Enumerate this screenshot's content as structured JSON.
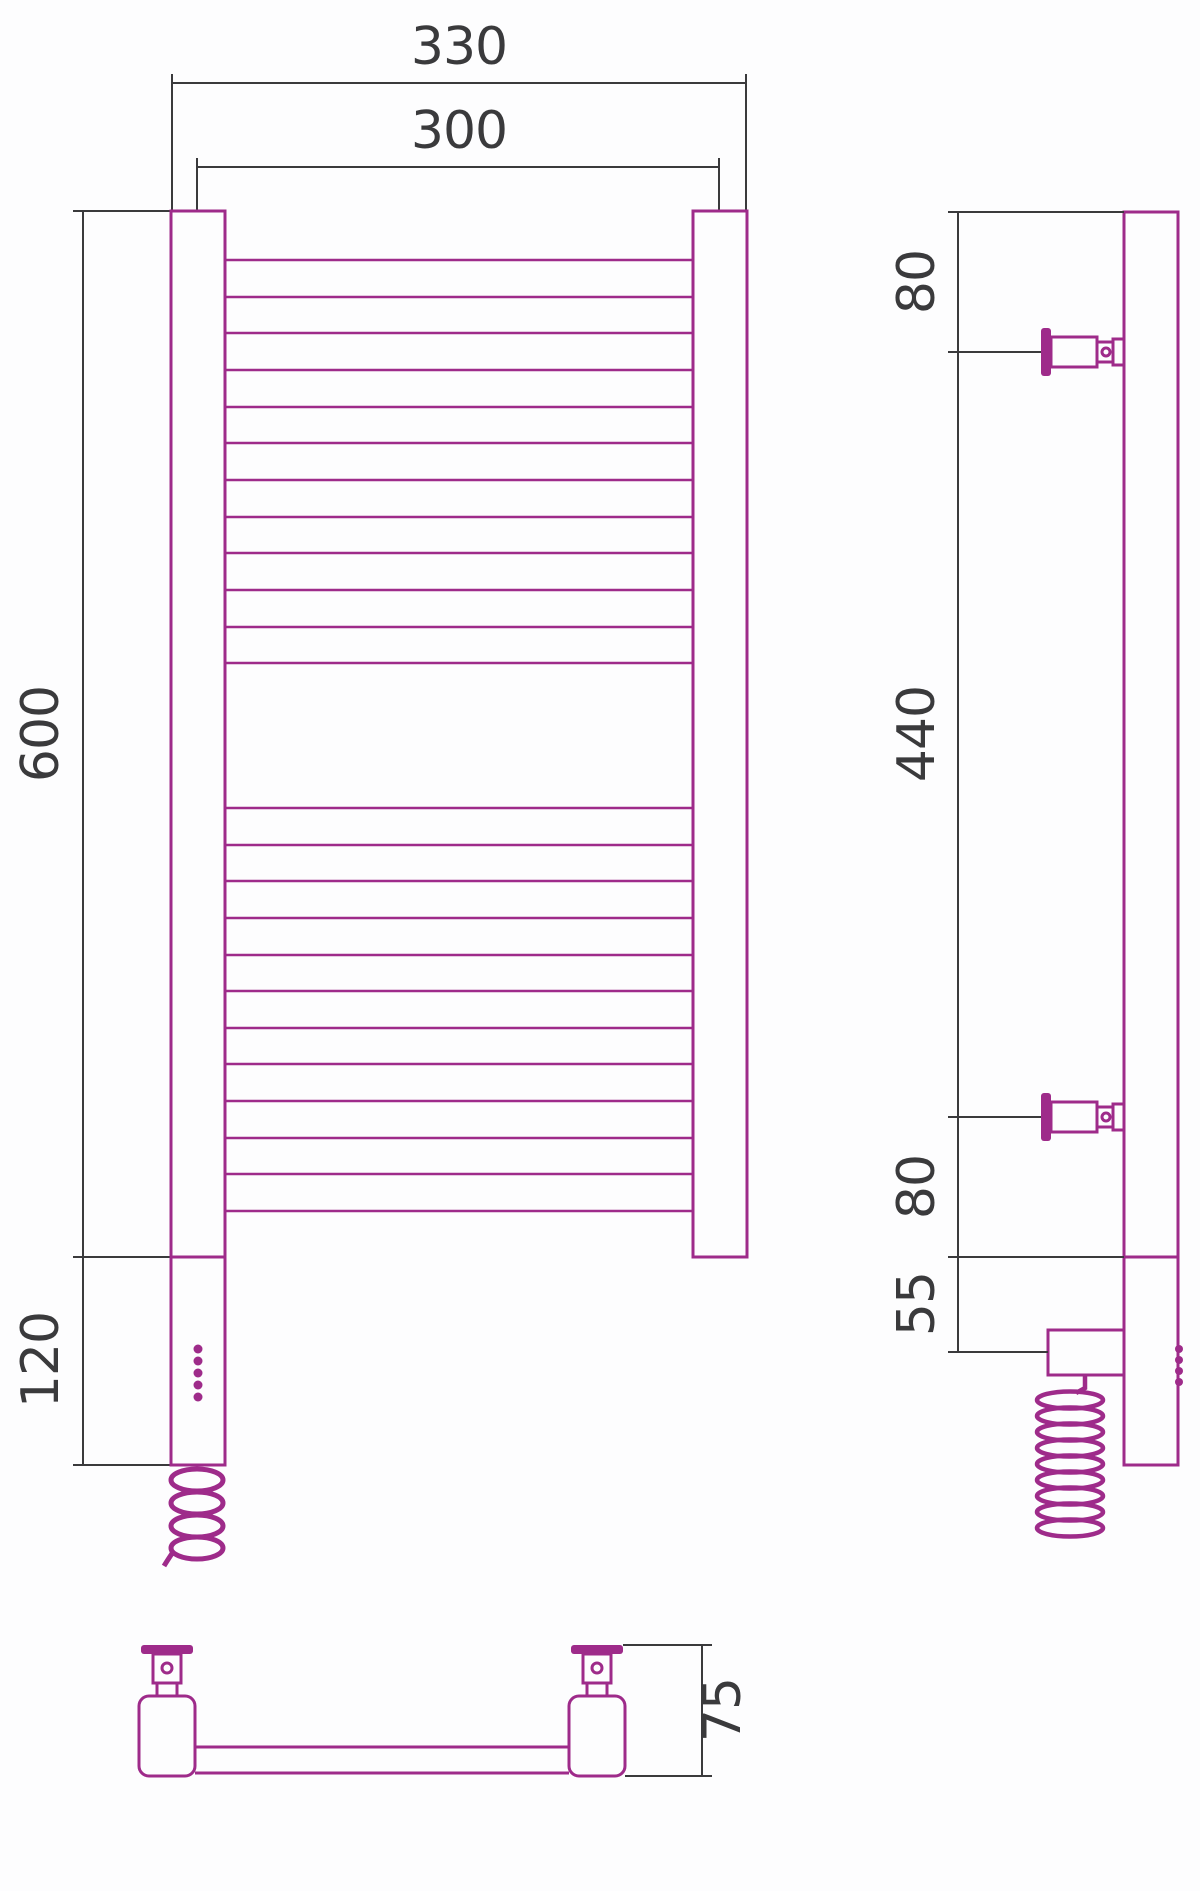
{
  "drawing": {
    "type": "technical-drawing",
    "subject": "ladder towel rail with electric heating element, three orthographic views",
    "colors": {
      "object_outline": "#9e2b8a",
      "dimension_lines": "#3a3a3c",
      "background": "#fdfdfe"
    },
    "dims": {
      "front_width_overall": "330",
      "front_width_centers": "300",
      "front_height_body": "600",
      "front_height_heater": "120",
      "side_top_to_bracket": "80",
      "side_bracket_span": "440",
      "side_bracket_to_bottom": "80",
      "side_bottom_to_terminal": "55",
      "bottom_depth": "75"
    },
    "front_view": {
      "rungs_top_group": 12,
      "rungs_bottom_group": 12,
      "led_dots": 5
    },
    "side_view": {
      "wall_brackets": 2,
      "led_bumps": 4
    }
  }
}
